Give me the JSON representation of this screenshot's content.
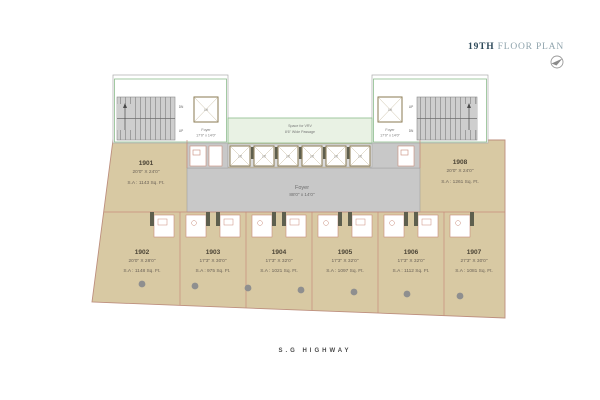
{
  "title": {
    "floor": "19TH",
    "rest": " FLOOR PLAN"
  },
  "highway_label": "S.G HIGHWAY",
  "lift_label": "Lift",
  "stairs": {
    "up": "UP",
    "dn": "DN"
  },
  "vrv": {
    "line1": "Space for VRV",
    "line2": "8'6\" Wide Passage"
  },
  "corridor": {
    "name": "Foyer",
    "dims": "88'0\" x 14'0\""
  },
  "foyer_left": {
    "name": "Foyer",
    "dims": "17'0\" x 14'0\""
  },
  "foyer_right": {
    "name": "Foyer",
    "dims": "17'0\" x 14'0\""
  },
  "units": [
    {
      "id": "1901",
      "dims": "20'0\" X 24'0\"",
      "area": "S.A : 1143 Sq. Ft."
    },
    {
      "id": "1902",
      "dims": "20'0\" X 28'0\"",
      "area": "S.A : 1148 Sq. Ft."
    },
    {
      "id": "1903",
      "dims": "17'3\" X 30'0\"",
      "area": "S.A : 975 Sq. Ft."
    },
    {
      "id": "1904",
      "dims": "17'3\" X 32'0\"",
      "area": "S.A : 1021 Sq. Ft."
    },
    {
      "id": "1905",
      "dims": "17'3\" X 32'0\"",
      "area": "S.A : 1097 Sq. Ft."
    },
    {
      "id": "1906",
      "dims": "17'3\" X 32'0\"",
      "area": "S.A : 1112 Sq. Ft."
    },
    {
      "id": "1907",
      "dims": "27'3\" X 30'0\"",
      "area": "S.A : 1081 Sq. Ft."
    },
    {
      "id": "1908",
      "dims": "20'0\" X 24'0\"",
      "area": "S.A : 1261 Sq. Ft."
    }
  ],
  "colors": {
    "unit_fill": "#d8c9a3",
    "unit_outline": "#bd8f7e",
    "corridor_fill": "#c8c8c8",
    "service_green": "#8cbc8c",
    "vrv_fill": "#e9f2e4",
    "bath_outline": "#c98b7b",
    "door_jamb": "#5e5f4e",
    "title_dark": "#2e4a5a",
    "title_light": "#90a4ad"
  }
}
